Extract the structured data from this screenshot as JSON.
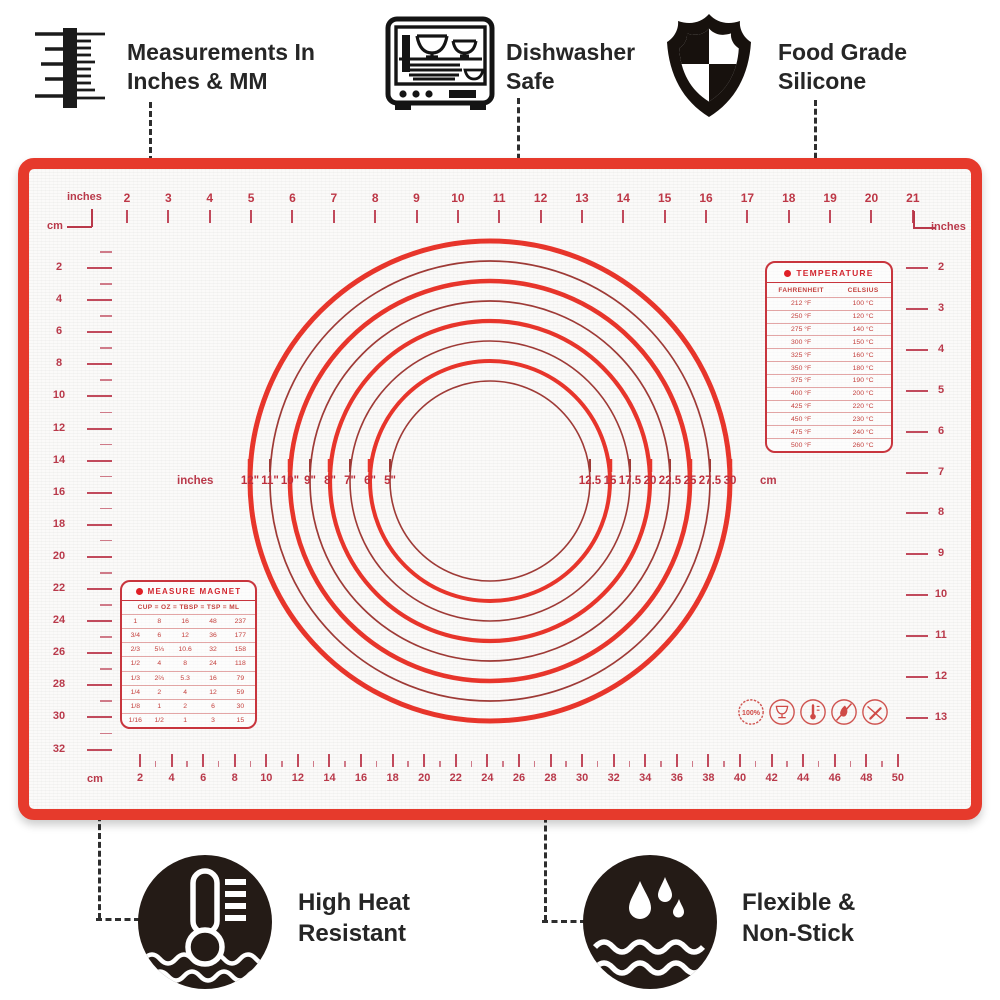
{
  "callouts": {
    "measurements": {
      "line1": "Measurements In",
      "line2": "Inches & MM"
    },
    "dishwasher": {
      "line1": "Dishwasher",
      "line2": "Safe"
    },
    "food_grade": {
      "line1": "Food Grade",
      "line2": "Silicone"
    },
    "high_heat": {
      "line1": "High Heat",
      "line2": "Resistant"
    },
    "flexible": {
      "line1": "Flexible &",
      "line2": "Non-Stick"
    }
  },
  "mat": {
    "top_ruler": {
      "unit": "inches",
      "numbers": [
        2,
        3,
        4,
        5,
        6,
        7,
        8,
        9,
        10,
        11,
        12,
        13,
        14,
        15,
        16,
        17,
        18,
        19,
        20,
        21
      ]
    },
    "right_ruler": {
      "unit": "inches",
      "numbers": [
        2,
        3,
        4,
        5,
        6,
        7,
        8,
        9,
        10,
        11,
        12,
        13
      ]
    },
    "left_ruler": {
      "unit": "cm",
      "numbers": [
        2,
        4,
        6,
        8,
        10,
        12,
        14,
        16,
        18,
        20,
        22,
        24,
        26,
        28,
        30,
        32
      ]
    },
    "bottom_ruler": {
      "unit": "cm",
      "numbers": [
        2,
        4,
        6,
        8,
        10,
        12,
        14,
        16,
        18,
        20,
        22,
        24,
        26,
        28,
        30,
        32,
        34,
        36,
        38,
        40,
        42,
        44,
        46,
        48,
        50
      ]
    },
    "circle_labels": {
      "left_unit": "inches",
      "left": [
        "12\"",
        "11\"",
        "10\"",
        "9\"",
        "8\"",
        "7\"",
        "6\"",
        "5\""
      ],
      "right": [
        "12.5",
        "15",
        "17.5",
        "20",
        "22.5",
        "25",
        "27.5",
        "30"
      ],
      "right_unit": "cm"
    },
    "temperature_table": {
      "title": "TEMPERATURE",
      "columns": [
        "FAHRENHEIT",
        "CELSIUS"
      ],
      "rows": [
        [
          "212 °F",
          "100 °C"
        ],
        [
          "250 °F",
          "120 °C"
        ],
        [
          "275 °F",
          "140 °C"
        ],
        [
          "300 °F",
          "150 °C"
        ],
        [
          "325 °F",
          "160 °C"
        ],
        [
          "350 °F",
          "180 °C"
        ],
        [
          "375 °F",
          "190 °C"
        ],
        [
          "400 °F",
          "200 °C"
        ],
        [
          "425 °F",
          "220 °C"
        ],
        [
          "450 °F",
          "230 °C"
        ],
        [
          "475 °F",
          "240 °C"
        ],
        [
          "500 °F",
          "260 °C"
        ]
      ]
    },
    "measure_table": {
      "title": "MEASURE MAGNET",
      "header_text": "CUP = OZ = TBSP = TSP = ML",
      "rows": [
        [
          "1",
          "8",
          "16",
          "48",
          "237"
        ],
        [
          "3/4",
          "6",
          "12",
          "36",
          "177"
        ],
        [
          "2/3",
          "5⅓",
          "10.6",
          "32",
          "158"
        ],
        [
          "1/2",
          "4",
          "8",
          "24",
          "118"
        ],
        [
          "1/3",
          "2⅔",
          "5.3",
          "16",
          "79"
        ],
        [
          "1/4",
          "2",
          "4",
          "12",
          "59"
        ],
        [
          "1/8",
          "1",
          "2",
          "6",
          "30"
        ],
        [
          "1/16",
          "1/2",
          "1",
          "3",
          "15"
        ]
      ]
    },
    "badges": {
      "percent_label": "100%"
    }
  },
  "colors": {
    "mat_red": "#e63a2c",
    "ruler_red": "#b9394a",
    "ring_thick": "#e7352b",
    "ring_thin": "#9e3a36",
    "table_red": "#c8353d",
    "callout_black": "#1d1d1d"
  }
}
